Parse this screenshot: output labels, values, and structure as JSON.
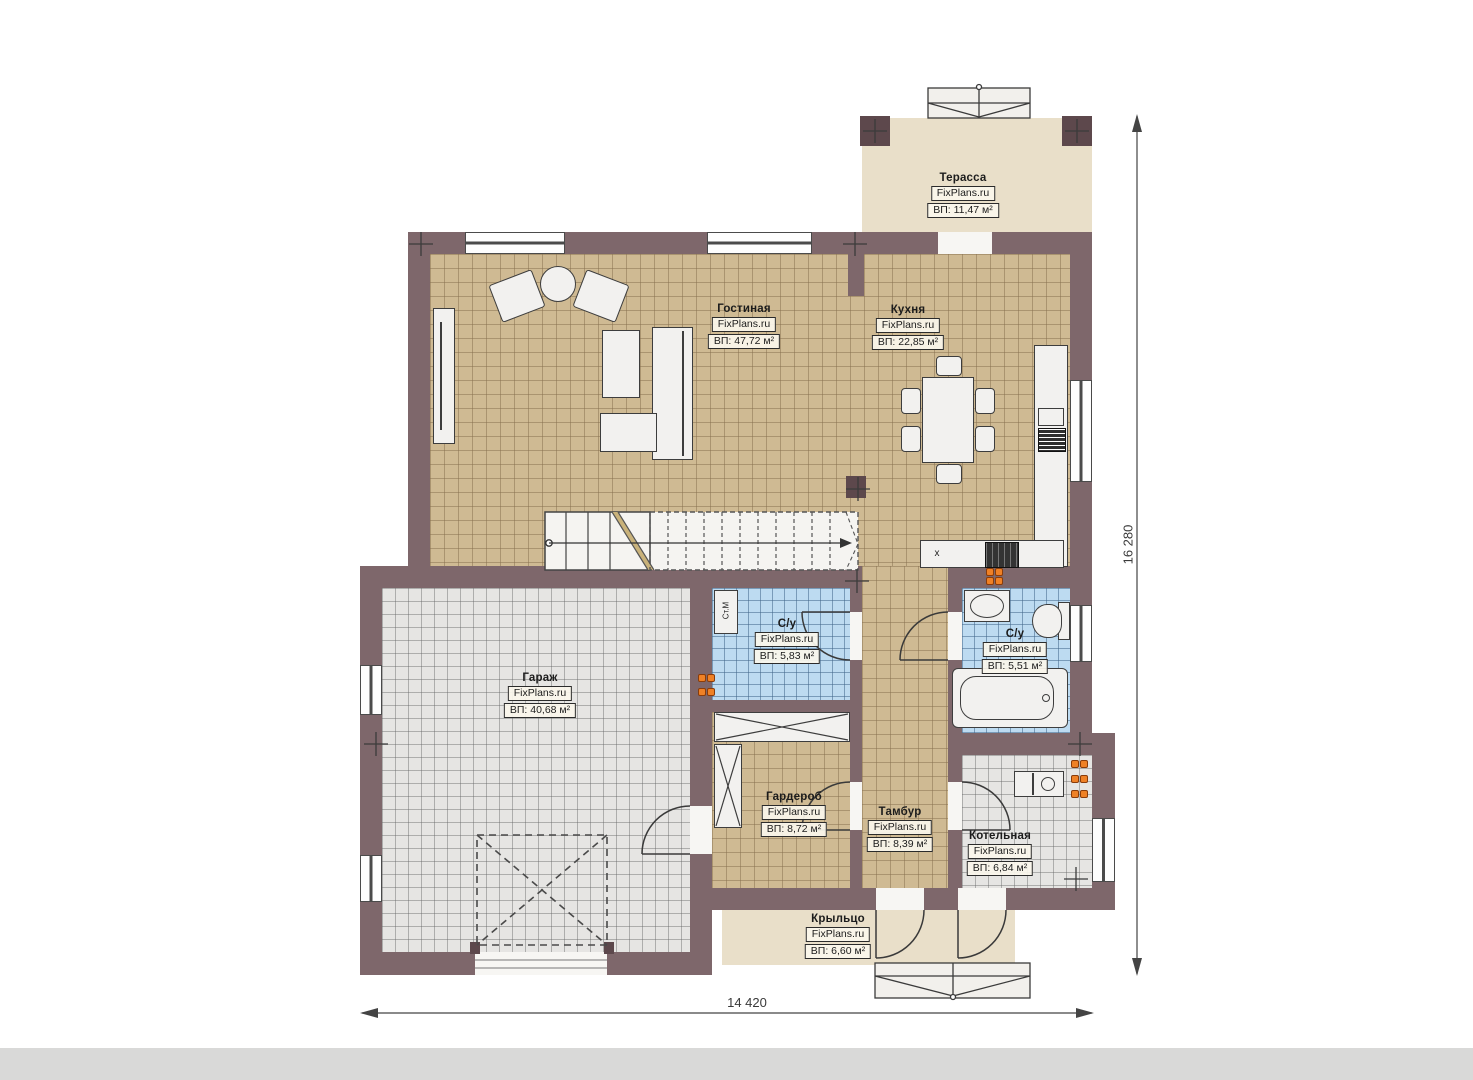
{
  "plan_title": "План 1 этажа",
  "watermark": "FixPlans.ru",
  "rooms": [
    {
      "name": "Терасса",
      "watermark": "FixPlans.ru",
      "area": "ВП: 11,47 м²"
    },
    {
      "name": "Гостиная",
      "watermark": "FixPlans.ru",
      "area": "ВП: 47,72 м²"
    },
    {
      "name": "Кухня",
      "watermark": "FixPlans.ru",
      "area": "ВП: 22,85 м²"
    },
    {
      "name": "Гараж",
      "watermark": "FixPlans.ru",
      "area": "ВП: 40,68 м²"
    },
    {
      "name": "С/у",
      "watermark": "FixPlans.ru",
      "area": "ВП: 5,83 м²"
    },
    {
      "name": "С/у",
      "watermark": "FixPlans.ru",
      "area": "ВП: 5,51 м²"
    },
    {
      "name": "Гардероб",
      "watermark": "FixPlans.ru",
      "area": "ВП: 8,72 м²"
    },
    {
      "name": "Тамбур",
      "watermark": "FixPlans.ru",
      "area": "ВП: 8,39 м²"
    },
    {
      "name": "Котельная",
      "watermark": "FixPlans.ru",
      "area": "ВП: 6,84 м²"
    },
    {
      "name": "Крыльцо",
      "watermark": "FixPlans.ru",
      "area": "ВП: 6,60 м²"
    }
  ],
  "dimensions": {
    "width": "14 420",
    "height": "16 280"
  },
  "annotations": {
    "washing_machine": "Ст.М",
    "kitchen_cabinet": "x"
  },
  "colors": {
    "wall": "#7e676b",
    "wall_dark": "#5d484c",
    "floor_tan": "#cfba93",
    "floor_gray": "#e6e5e3",
    "floor_blue": "#bddbf1",
    "floor_beige": "#e9dfc9",
    "radiator": "#ef8126"
  }
}
